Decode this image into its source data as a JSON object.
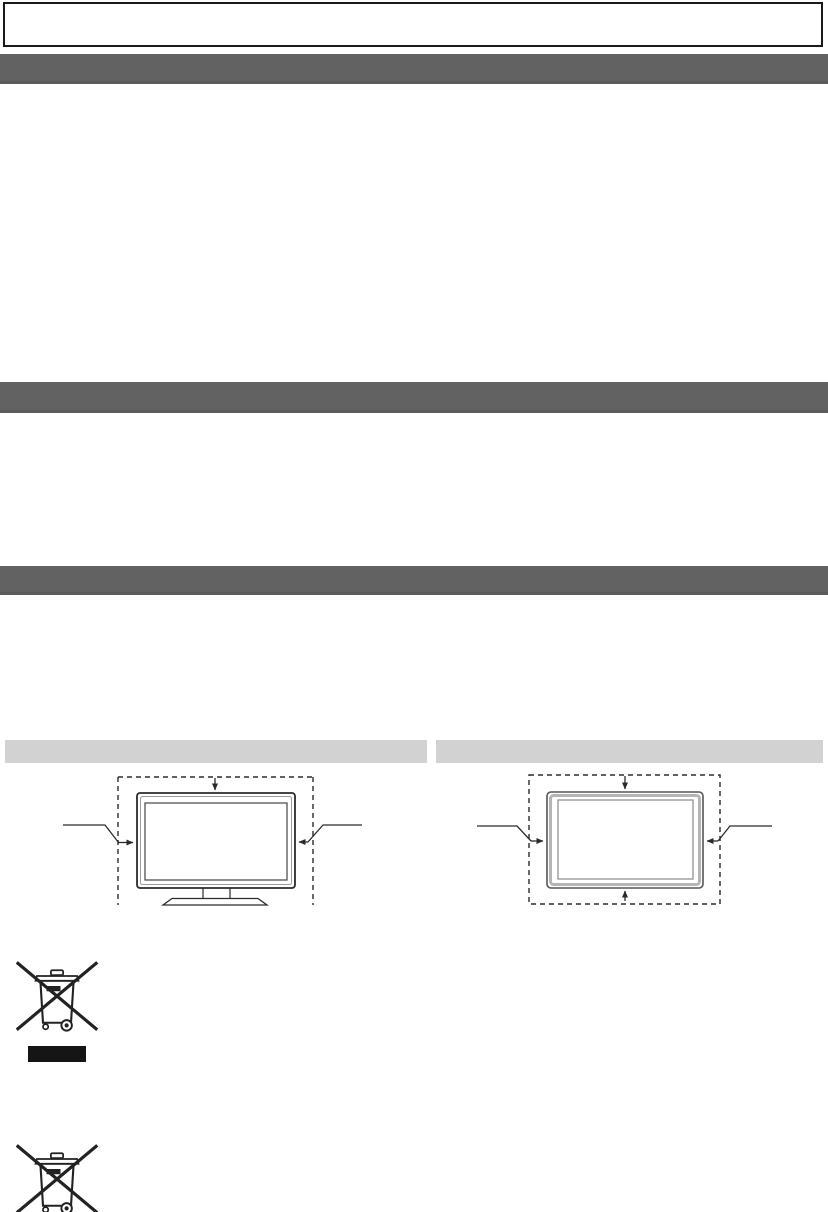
{
  "page": {
    "description": "Scanned TV-manual page rendered without its text layer: empty framed note box, three dark section header bars, two light sub-header bars, two TV ventilation-clearance diagrams (stand mount and wall mount), and WEEE crossed-out wheelie-bin disposal symbols"
  },
  "colors": {
    "page_bg": "#ffffff",
    "section_bar": "#626262",
    "subsection_bar": "#d2d2d2",
    "note_box_border": "#1a1a1a",
    "line_art": "#2b2b2b",
    "tv_frame_gray": "#b5b5b5",
    "weee_black": "#151515"
  },
  "note_box": {
    "text": ""
  },
  "section_bars": [
    {
      "id": "section-1",
      "label": ""
    },
    {
      "id": "section-2",
      "label": ""
    },
    {
      "id": "section-3",
      "label": ""
    }
  ],
  "subsection_bars": [
    {
      "id": "left",
      "label": ""
    },
    {
      "id": "right",
      "label": ""
    }
  ],
  "diagrams": {
    "left": {
      "name": "tv-ventilation-clearance-with-stand",
      "caption": ""
    },
    "right": {
      "name": "tv-ventilation-clearance-wall-mount",
      "caption": ""
    }
  },
  "icons": {
    "weee_bin_top": {
      "name": "crossed-out-wheelie-bin-icon",
      "has_black_bar": true
    },
    "weee_bin_bottom": {
      "name": "crossed-out-wheelie-bin-icon",
      "has_black_bar": false
    }
  }
}
